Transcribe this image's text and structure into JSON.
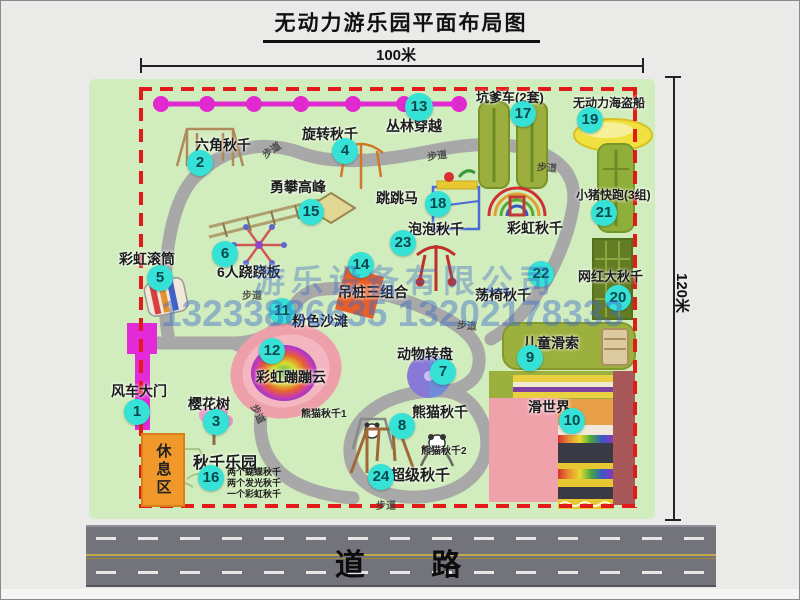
{
  "title": "无动力游乐园平面布局图",
  "dims": {
    "top": "100米",
    "right": "120米"
  },
  "road": {
    "label": "道 路"
  },
  "watermark": {
    "company": "游乐设备有限公司",
    "phone": "13233886635 13202178333"
  },
  "labels": {
    "walkway": "步道",
    "rest_area": "休息区",
    "rainbow_swing": "彩虹秋千"
  },
  "notes": [
    "两个蝴蝶秋千",
    "两个发光秋千",
    "一个彩虹秋千"
  ],
  "panda": {
    "sub1": "熊猫秋千1",
    "sub2": "熊猫秋千2"
  },
  "attractions": [
    {
      "num": "1",
      "name": "风车大门"
    },
    {
      "num": "2",
      "name": "六角秋千"
    },
    {
      "num": "3",
      "name": "樱花树"
    },
    {
      "num": "4",
      "name": "旋转秋千"
    },
    {
      "num": "5",
      "name": "彩虹滚筒"
    },
    {
      "num": "6",
      "name": "6人跷跷板"
    },
    {
      "num": "7",
      "name": "动物转盘"
    },
    {
      "num": "8",
      "name": "熊猫秋千"
    },
    {
      "num": "9",
      "name": "儿童滑索"
    },
    {
      "num": "10",
      "name": "滑世界"
    },
    {
      "num": "11",
      "name": "粉色沙滩"
    },
    {
      "num": "12",
      "name": "彩虹蹦蹦云"
    },
    {
      "num": "13",
      "name": "丛林穿越"
    },
    {
      "num": "14",
      "name": "吊桩三组合"
    },
    {
      "num": "15",
      "name": "勇攀高峰"
    },
    {
      "num": "16",
      "name": "秋千乐园"
    },
    {
      "num": "17",
      "name": "坑爹车(2套)"
    },
    {
      "num": "18",
      "name": "跳跳马"
    },
    {
      "num": "19",
      "name": "无动力海盗船"
    },
    {
      "num": "20",
      "name": "网红大秋千"
    },
    {
      "num": "21",
      "name": "小猪快跑(3组)"
    },
    {
      "num": "22",
      "name": "荡椅秋千"
    },
    {
      "num": "23",
      "name": "泡泡秋千"
    },
    {
      "num": "24",
      "name": "超级秋千"
    }
  ],
  "colors": {
    "badge_cyan": "#35e2d5",
    "boundary_red": "#e31a1a",
    "map_green": "#d2edbd",
    "gate_magenta": "#e32ad8",
    "zipline_magenta": "#e02ad0",
    "rest_area_orange": "#f0982a",
    "road_gray": "#73737b"
  }
}
